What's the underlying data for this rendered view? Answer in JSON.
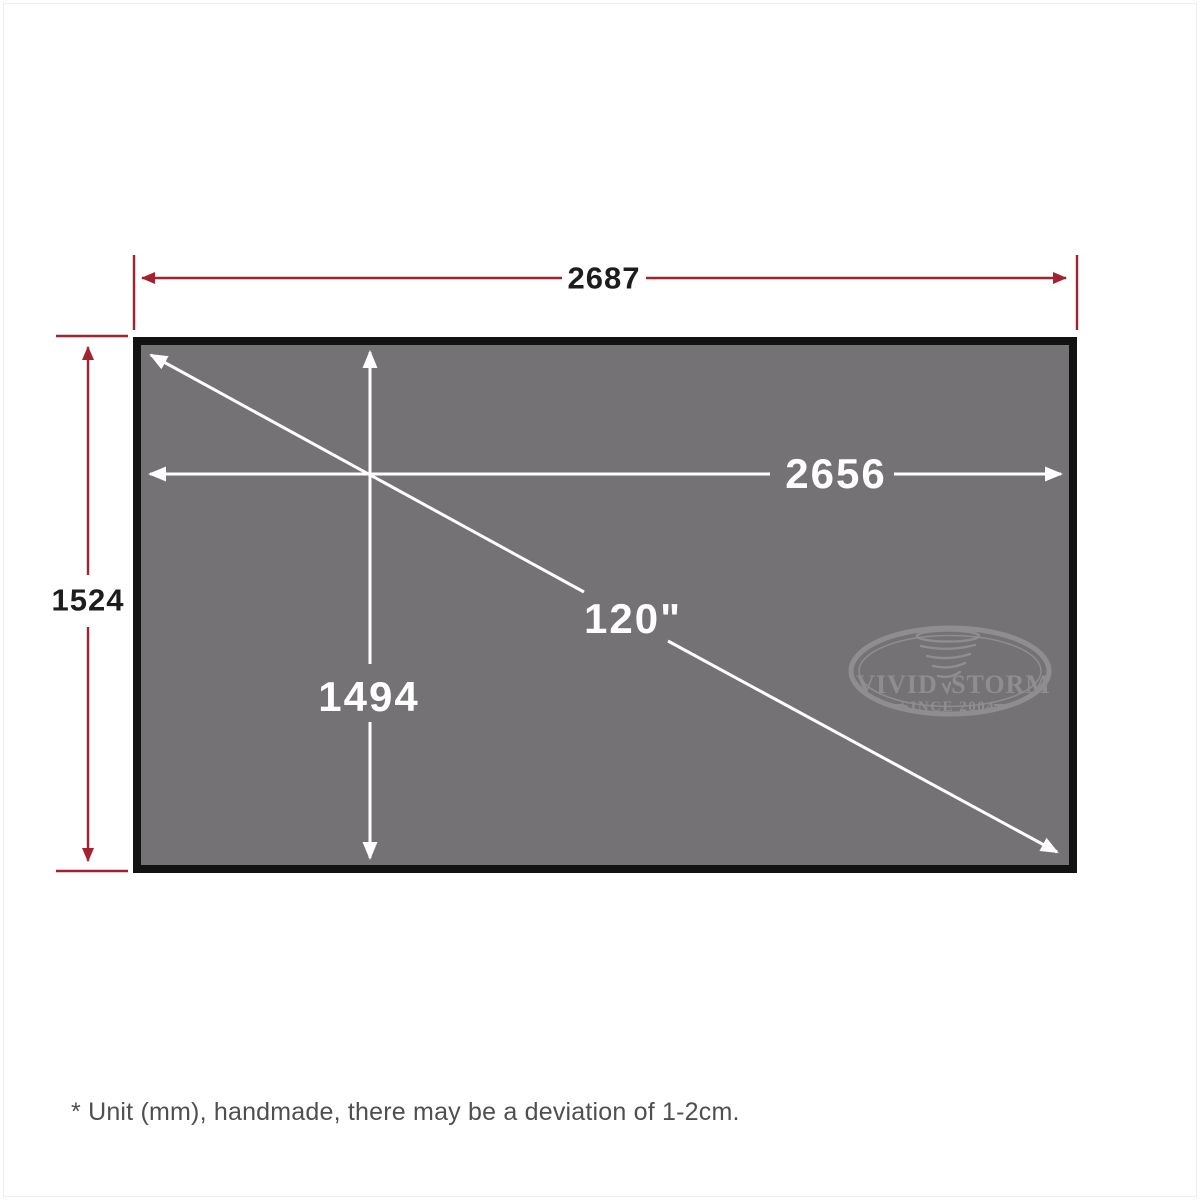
{
  "diagram": {
    "title": "projector-screen-dimension-diagram",
    "outer_width_label": "2687",
    "outer_height_label": "1524",
    "viewable_width_label": "2656",
    "viewable_height_label": "1494",
    "diagonal_label": "120\"",
    "footnote": "* Unit (mm), handmade, there may be a deviation of 1-2cm."
  },
  "logo": {
    "brand_left": "VIVID",
    "brand_right": "STORM",
    "tagline": "SINCE 2004"
  },
  "colors": {
    "outer_dimension_red": "#a42130",
    "inner_dimension_white": "#ffffff",
    "screen_fill_gray": "#757275",
    "screen_border_black": "#121212",
    "outer_label_text": "#1d1d1d",
    "footnote_text": "#4f4f4f",
    "logo_watermark_gray": "#8f8d8f",
    "page_background": "#ffffff"
  }
}
